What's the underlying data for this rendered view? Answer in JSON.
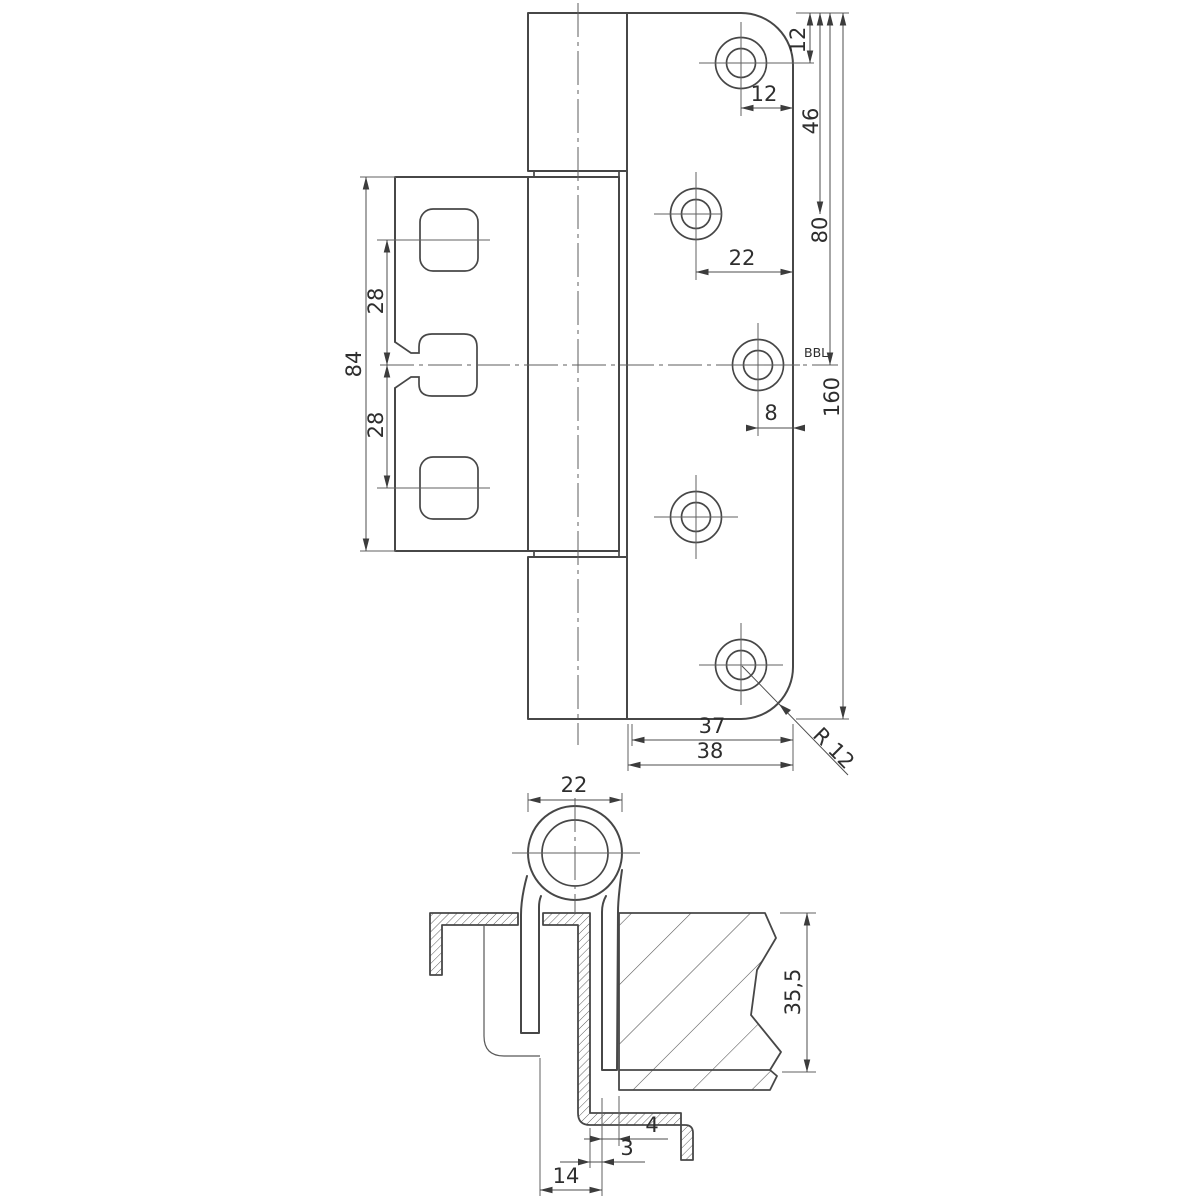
{
  "drawing_title": "hinge-technical-drawing",
  "colors": {
    "background": "#ffffff",
    "outline": "#474747",
    "thin_line": "#626262",
    "text": "#2e2e2e"
  },
  "front_view": {
    "name": "hinge front elevation",
    "dims": {
      "hole1_top_offset": "12",
      "hole2_top_offset": "46",
      "hole3_top_offset": "80",
      "plate_height": "160",
      "hole1_edge_inset": "12",
      "hole2_edge_inset": "22",
      "hole3_edge_inset": "8",
      "reference_label": "BBL",
      "leaf_height": "84",
      "slot_pitch_upper": "28",
      "slot_pitch_lower": "28",
      "plate_flat_width": "37",
      "plate_width": "38",
      "corner_radius": "R 12"
    }
  },
  "section_view": {
    "name": "hinge horizontal section",
    "dims": {
      "knuckle_diameter": "22",
      "frame_depth": "35,5",
      "gap_width": "4",
      "material_thickness": "3",
      "strap_offset": "14"
    }
  }
}
